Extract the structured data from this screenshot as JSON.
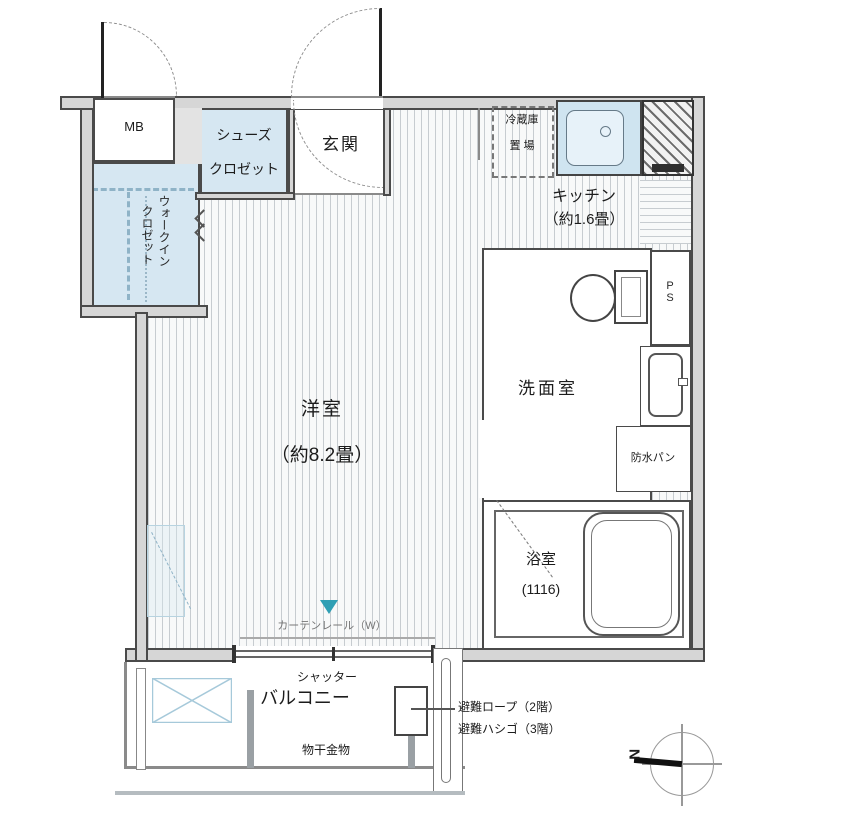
{
  "floorplan": {
    "labels": {
      "mb": "MB",
      "shoe_closet_line1": "シューズ",
      "shoe_closet_line2": "クロゼット",
      "entrance": "玄関",
      "wic_col_right": "ウォークイン",
      "wic_col_left": "クロゼット",
      "fridge_line1": "冷蔵庫",
      "fridge_line2": "置 場",
      "kitchen_name": "キッチン",
      "kitchen_size": "（約1.6畳）",
      "room_name": "洋室",
      "room_size": "（約8.2畳）",
      "washroom": "洗面室",
      "ps": "PS",
      "waterproof_pan": "防水パン",
      "bath_name": "浴室",
      "bath_size": "(1116)",
      "curtain_rail": "カーテンレール（W）",
      "shutter": "シャッター",
      "balcony": "バルコニー",
      "laundry_hardware": "物干金物",
      "evac_rope": "避難ロープ（2階）",
      "evac_ladder": "避難ハシゴ（3階）",
      "compass_north": "N"
    },
    "colors": {
      "closet_fill": "#d6e7f2",
      "wall_fill": "#d6d6d6",
      "wall_line": "#4a4a4a",
      "floor_stripe": "#c7ccd0",
      "accent_teal": "#2f9fb4",
      "hatch_blue": "#8fb3c7"
    }
  }
}
